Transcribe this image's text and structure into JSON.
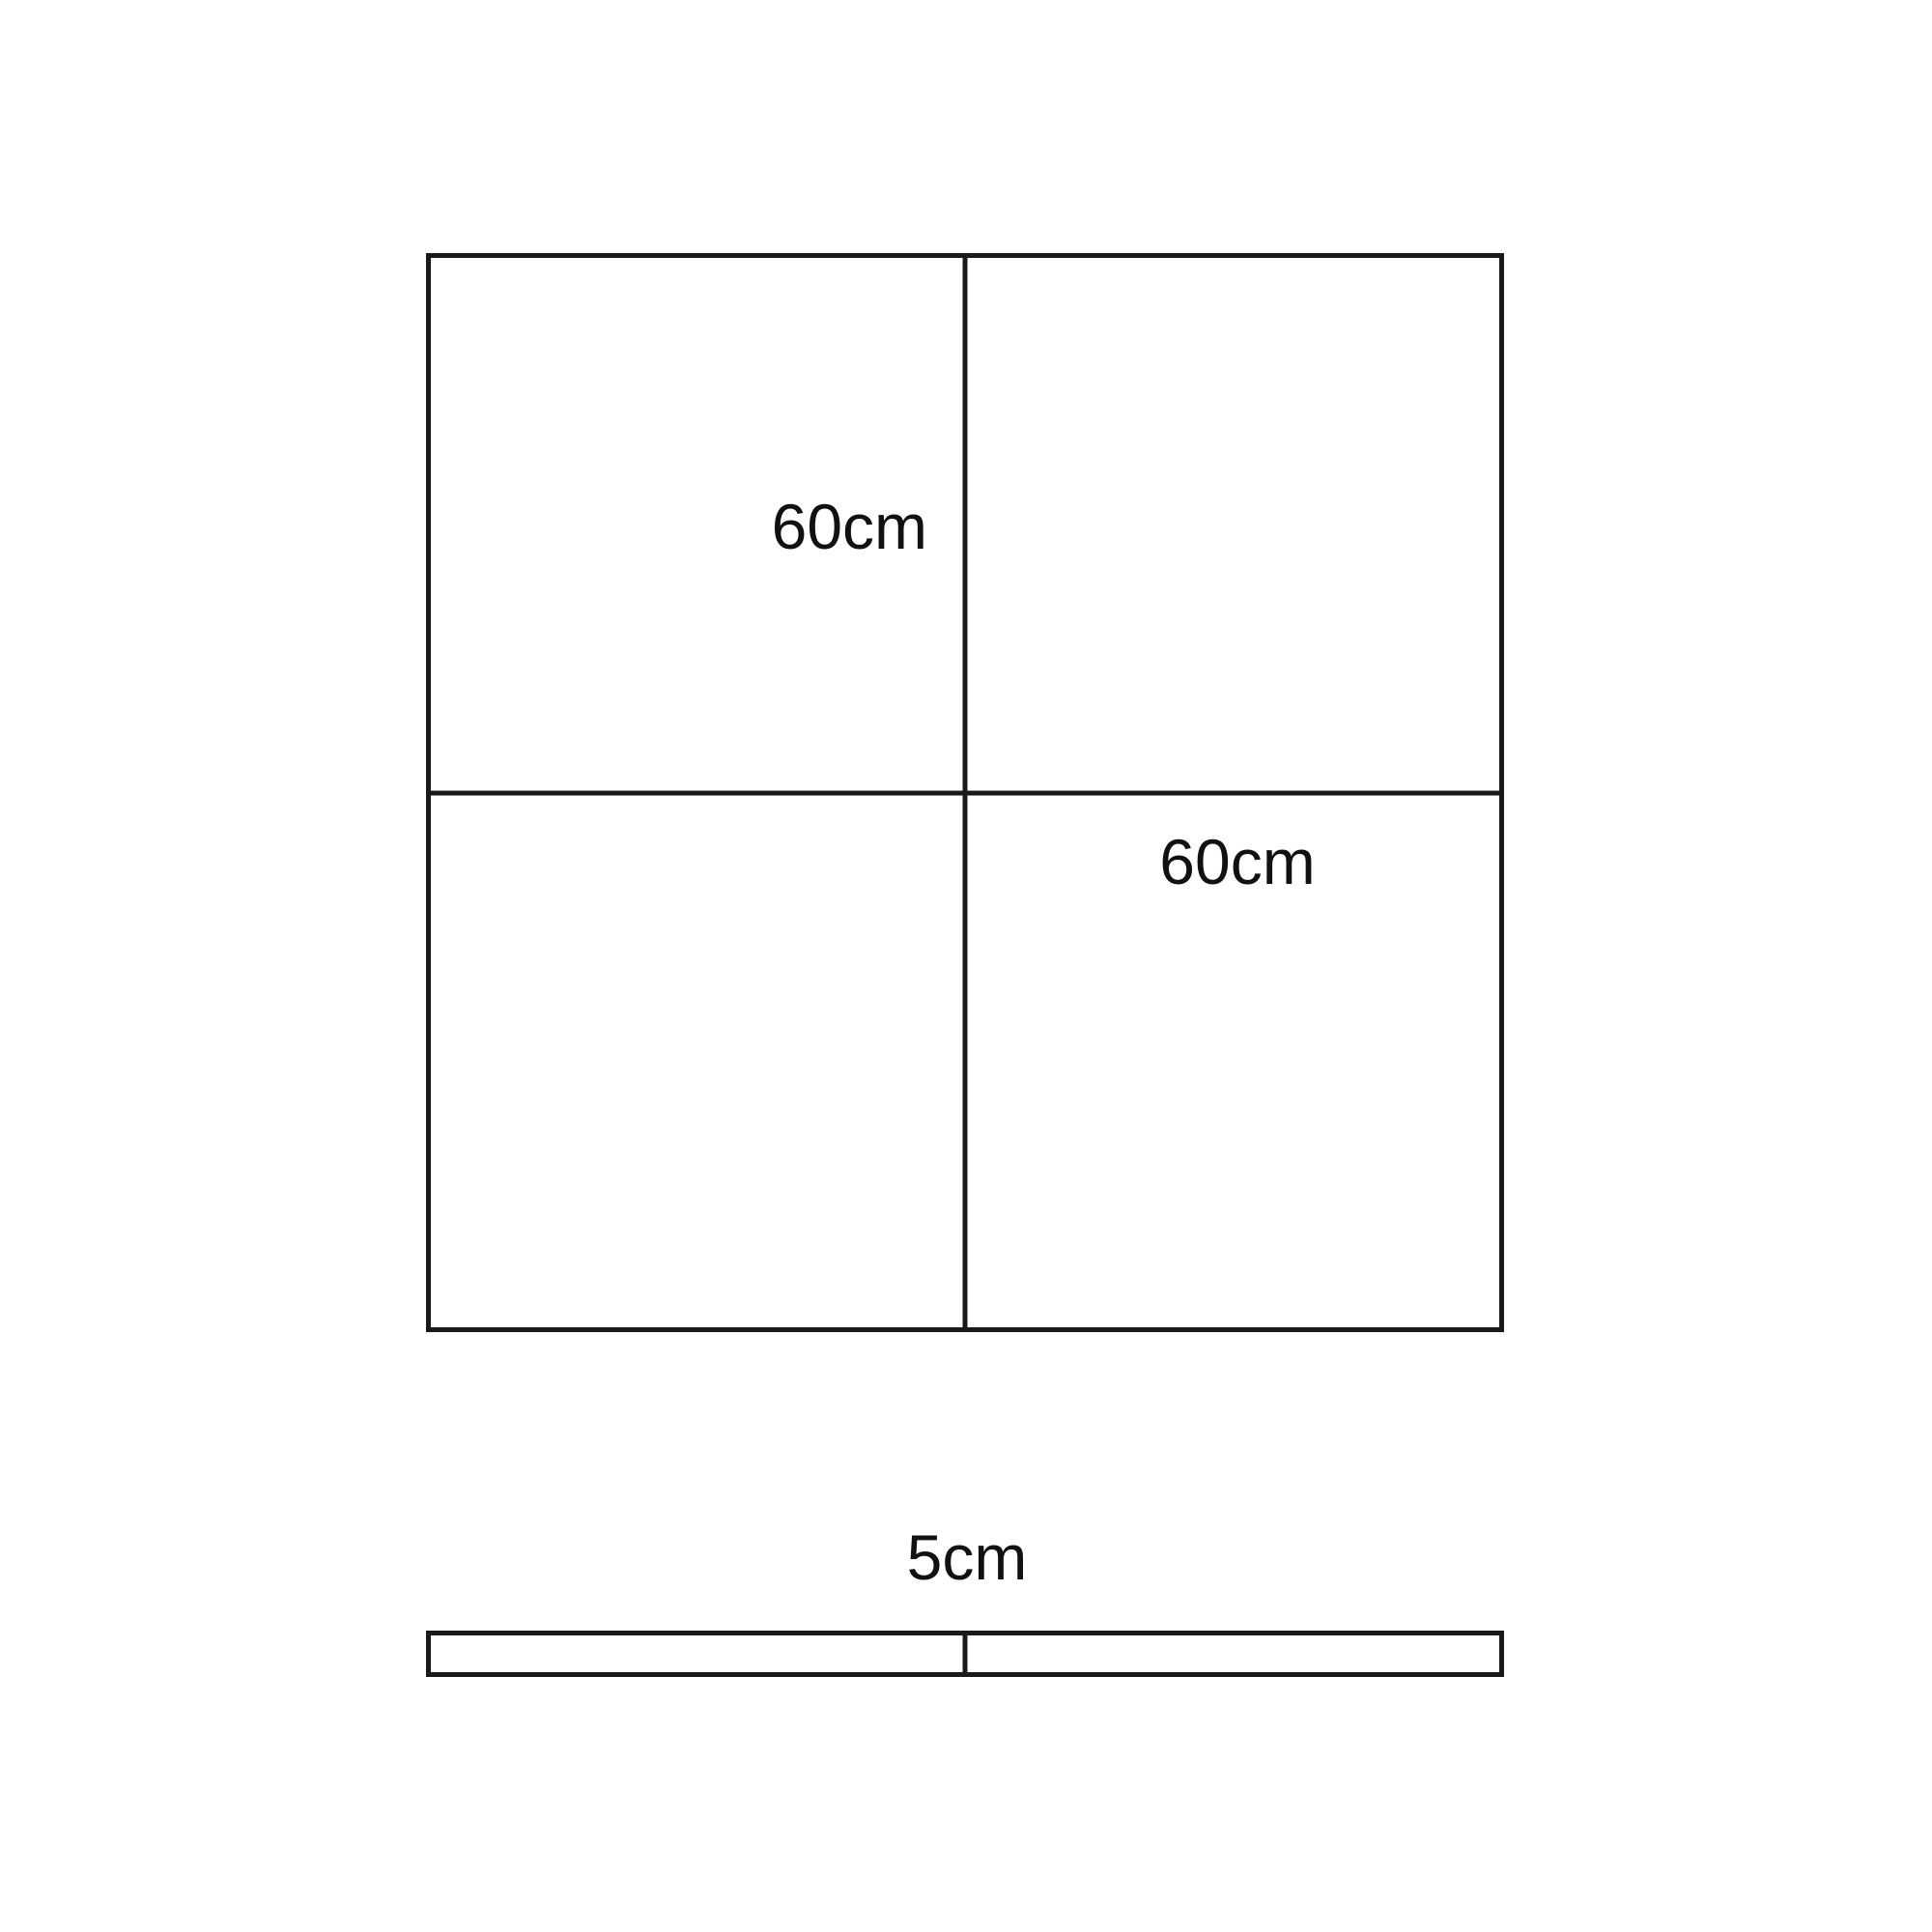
{
  "page": {
    "background": "#ffffff"
  },
  "diagram": {
    "stroke_color": "#1a1a1a",
    "text_color": "#111111",
    "square": {
      "rows": 2,
      "columns": 2,
      "label_top_left": "60cm",
      "label_bottom_right": "60cm"
    },
    "bar": {
      "segments": 2,
      "label": "5cm"
    }
  }
}
